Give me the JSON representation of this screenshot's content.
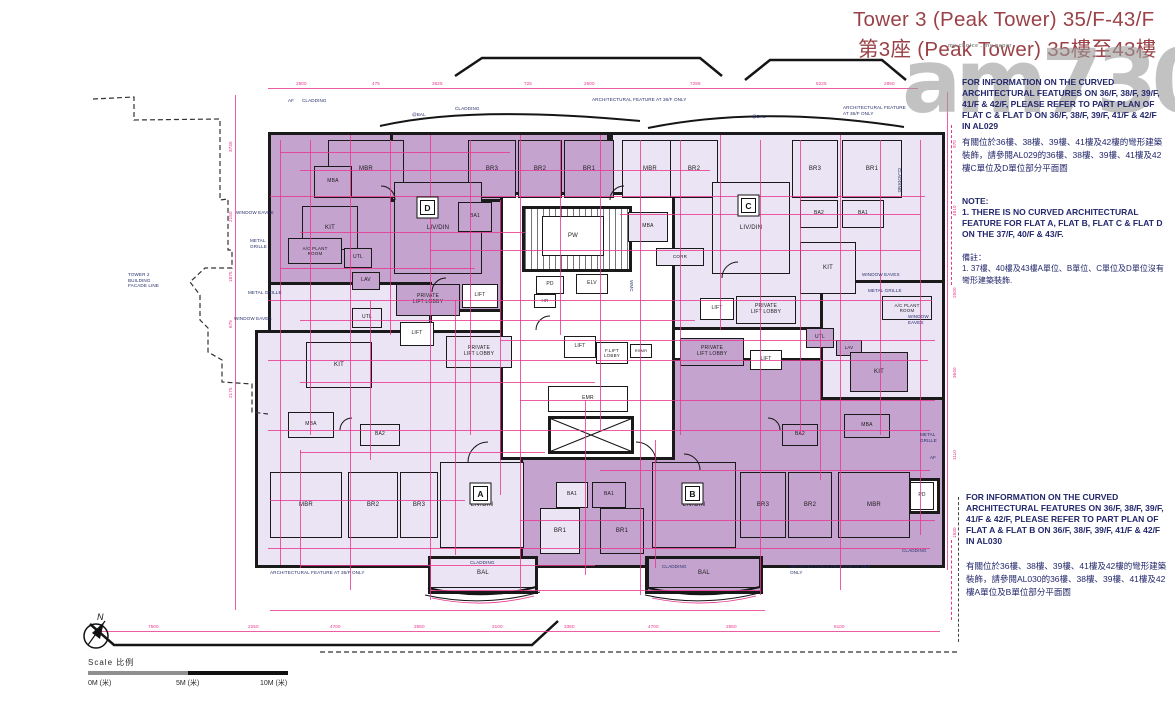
{
  "title": {
    "line1": "Tower 3 (Peak Tower) 35/F-43/F",
    "line2": "第3座 (Peak Tower) 35樓至43樓"
  },
  "watermark": {
    "main": "am730",
    "tagline": "my choice . my paper"
  },
  "notes_right": {
    "al029_en": "FOR INFORMATION ON THE CURVED ARCHITECTURAL FEATURES ON 36/F, 38/F, 39/F, 41/F & 42/F, PLEASE REFER TO PART PLAN OF FLAT C & FLAT D ON 36/F, 38/F, 39/F, 41/F & 42/F IN AL029",
    "al029_zh": "有關位於36樓、38樓、39樓、41樓及42樓的彎形建築裝飾，請參閱AL029的36樓、38樓、39樓、41樓及42樓C單位及D單位部分平面圖",
    "note_title": "NOTE:",
    "note_body": "1. THERE IS NO CURVED ARCHITECTURAL FEATURE FOR FLAT A, FLAT B, FLAT C & FLAT D ON THE 37/F, 40/F & 43/F.",
    "remark_title": "備註：",
    "remark_body": "1. 37樓、40樓及43樓A單位、B單位、C單位及D單位沒有彎形建築裝飾.",
    "al030_en": "FOR INFORMATION ON THE CURVED ARCHITECTURAL FEATURES ON 36/F, 38/F, 39/F, 41/F & 42/F, PLEASE REFER TO PART PLAN OF FLAT A & FLAT B ON 36/F, 38/F, 39/F, 41/F & 42/F IN AL030",
    "al030_zh": "有關位於36樓、38樓、39樓、41樓及42樓的彎形建築裝飾，請參閱AL030的36樓、38樓、39樓、41樓及42樓A單位及B單位部分平面圖"
  },
  "scale": {
    "label": "Scale  比例",
    "t0": "0M (米)",
    "t5": "5M (米)",
    "t10": "10M (米)"
  },
  "compass": {
    "label": "N"
  },
  "colors": {
    "dim_pink": "#e8348c",
    "room_dark": "#c5a3cf",
    "room_light": "#eae4f4",
    "title_maroon": "#9a4247",
    "note_navy": "#23276b"
  },
  "plan": {
    "walls": [
      {
        "x": 268,
        "y": 132,
        "w": 252,
        "h": 180,
        "f": "d"
      },
      {
        "x": 390,
        "y": 132,
        "w": 220,
        "h": 70,
        "f": "d"
      },
      {
        "x": 610,
        "y": 132,
        "w": 335,
        "h": 198,
        "f": "l"
      },
      {
        "x": 268,
        "y": 282,
        "w": 164,
        "h": 178,
        "f": "l"
      },
      {
        "x": 255,
        "y": 330,
        "w": 400,
        "h": 238,
        "f": "l"
      },
      {
        "x": 520,
        "y": 358,
        "w": 425,
        "h": 210,
        "f": "d"
      },
      {
        "x": 820,
        "y": 280,
        "w": 125,
        "h": 120,
        "f": "l"
      },
      {
        "x": 500,
        "y": 192,
        "w": 175,
        "h": 268,
        "f": "w"
      },
      {
        "x": 522,
        "y": 206,
        "w": 110,
        "h": 66,
        "f": "s"
      },
      {
        "x": 548,
        "y": 416,
        "w": 86,
        "h": 38,
        "f": "w"
      },
      {
        "x": 428,
        "y": 556,
        "w": 110,
        "h": 38,
        "f": "l"
      },
      {
        "x": 645,
        "y": 556,
        "w": 118,
        "h": 38,
        "f": "d"
      },
      {
        "x": 908,
        "y": 478,
        "w": 32,
        "h": 36,
        "f": "w"
      }
    ],
    "rooms": [
      {
        "t": "MBR",
        "x": 328,
        "y": 140,
        "w": 76,
        "h": 58,
        "f": "d"
      },
      {
        "t": "MBA",
        "x": 314,
        "y": 166,
        "w": 38,
        "h": 32,
        "f": "d",
        "fs": 5
      },
      {
        "t": "KIT",
        "x": 302,
        "y": 206,
        "w": 56,
        "h": 44,
        "f": "d"
      },
      {
        "t": "BR3",
        "x": 468,
        "y": 140,
        "w": 48,
        "h": 58,
        "f": "d"
      },
      {
        "t": "BR2",
        "x": 518,
        "y": 140,
        "w": 44,
        "h": 58,
        "f": "d"
      },
      {
        "t": "BR1",
        "x": 564,
        "y": 140,
        "w": 50,
        "h": 58,
        "f": "d"
      },
      {
        "t": "LIV/DIN",
        "x": 394,
        "y": 182,
        "w": 88,
        "h": 92,
        "f": "d"
      },
      {
        "t": "BA1",
        "x": 458,
        "y": 202,
        "w": 34,
        "h": 30,
        "f": "d",
        "fs": 5
      },
      {
        "t": "A/C PLANT\nROOM",
        "x": 288,
        "y": 238,
        "w": 54,
        "h": 26,
        "f": "d",
        "fs": 4.5
      },
      {
        "t": "UTL",
        "x": 344,
        "y": 248,
        "w": 28,
        "h": 20,
        "f": "d",
        "fs": 5
      },
      {
        "t": "LAV",
        "x": 352,
        "y": 272,
        "w": 28,
        "h": 18,
        "f": "d",
        "fs": 5
      },
      {
        "t": "PRIVATE\nLIFT LOBBY",
        "x": 396,
        "y": 284,
        "w": 64,
        "h": 32,
        "f": "d",
        "fs": 5
      },
      {
        "t": "MBR",
        "x": 622,
        "y": 140,
        "w": 56,
        "h": 58,
        "f": "l"
      },
      {
        "t": "BR2",
        "x": 670,
        "y": 140,
        "w": 48,
        "h": 58,
        "f": "l"
      },
      {
        "t": "MBA",
        "x": 628,
        "y": 212,
        "w": 40,
        "h": 30,
        "f": "l",
        "fs": 5
      },
      {
        "t": "CORR",
        "x": 656,
        "y": 248,
        "w": 48,
        "h": 18,
        "f": "l",
        "fs": 4.5
      },
      {
        "t": "LIV/DIN",
        "x": 712,
        "y": 182,
        "w": 78,
        "h": 92,
        "f": "l"
      },
      {
        "t": "BR3",
        "x": 792,
        "y": 140,
        "w": 46,
        "h": 58,
        "f": "l"
      },
      {
        "t": "BR1",
        "x": 842,
        "y": 140,
        "w": 60,
        "h": 58,
        "f": "l"
      },
      {
        "t": "BA2",
        "x": 800,
        "y": 200,
        "w": 38,
        "h": 28,
        "f": "l",
        "fs": 5
      },
      {
        "t": "BA1",
        "x": 842,
        "y": 200,
        "w": 42,
        "h": 28,
        "f": "l",
        "fs": 5
      },
      {
        "t": "KIT",
        "x": 800,
        "y": 242,
        "w": 56,
        "h": 52,
        "f": "l"
      },
      {
        "t": "UTL",
        "x": 806,
        "y": 328,
        "w": 28,
        "h": 20,
        "f": "d",
        "fs": 5
      },
      {
        "t": "LAV",
        "x": 836,
        "y": 340,
        "w": 26,
        "h": 16,
        "f": "d",
        "fs": 4.5
      },
      {
        "t": "A/C PLANT\nROOM",
        "x": 882,
        "y": 296,
        "w": 50,
        "h": 24,
        "f": "l",
        "fs": 4.5
      },
      {
        "t": "KIT",
        "x": 850,
        "y": 352,
        "w": 58,
        "h": 40,
        "f": "d"
      },
      {
        "t": "MBA",
        "x": 288,
        "y": 412,
        "w": 46,
        "h": 26,
        "f": "l",
        "fs": 5
      },
      {
        "t": "BA2",
        "x": 360,
        "y": 424,
        "w": 40,
        "h": 22,
        "f": "l",
        "fs": 5
      },
      {
        "t": "MBR",
        "x": 270,
        "y": 472,
        "w": 72,
        "h": 66,
        "f": "l"
      },
      {
        "t": "BR2",
        "x": 348,
        "y": 472,
        "w": 50,
        "h": 66,
        "f": "l"
      },
      {
        "t": "BR3",
        "x": 400,
        "y": 472,
        "w": 38,
        "h": 66,
        "f": "l"
      },
      {
        "t": "LIV/DIN",
        "x": 440,
        "y": 462,
        "w": 84,
        "h": 86,
        "f": "l"
      },
      {
        "t": "BA1",
        "x": 556,
        "y": 482,
        "w": 32,
        "h": 26,
        "f": "l",
        "fs": 5
      },
      {
        "t": "BR1",
        "x": 540,
        "y": 508,
        "w": 40,
        "h": 46,
        "f": "l"
      },
      {
        "t": "KIT",
        "x": 306,
        "y": 342,
        "w": 66,
        "h": 46,
        "f": "l"
      },
      {
        "t": "UTL",
        "x": 352,
        "y": 308,
        "w": 30,
        "h": 20,
        "f": "l",
        "fs": 5
      },
      {
        "t": "BAL",
        "x": 430,
        "y": 558,
        "w": 106,
        "h": 30,
        "f": "l"
      },
      {
        "t": "BA1",
        "x": 592,
        "y": 482,
        "w": 34,
        "h": 26,
        "f": "d",
        "fs": 5
      },
      {
        "t": "BR1",
        "x": 600,
        "y": 508,
        "w": 44,
        "h": 46,
        "f": "d"
      },
      {
        "t": "LIV/DIN",
        "x": 652,
        "y": 462,
        "w": 84,
        "h": 86,
        "f": "d"
      },
      {
        "t": "BR3",
        "x": 740,
        "y": 472,
        "w": 46,
        "h": 66,
        "f": "d"
      },
      {
        "t": "BR2",
        "x": 788,
        "y": 472,
        "w": 44,
        "h": 66,
        "f": "d"
      },
      {
        "t": "MBR",
        "x": 838,
        "y": 472,
        "w": 72,
        "h": 66,
        "f": "d"
      },
      {
        "t": "MBA",
        "x": 844,
        "y": 414,
        "w": 46,
        "h": 24,
        "f": "d",
        "fs": 5
      },
      {
        "t": "BA2",
        "x": 782,
        "y": 424,
        "w": 36,
        "h": 22,
        "f": "d",
        "fs": 5
      },
      {
        "t": "BAL",
        "x": 648,
        "y": 558,
        "w": 112,
        "h": 30,
        "f": "d"
      },
      {
        "t": "PD",
        "x": 910,
        "y": 482,
        "w": 24,
        "h": 28,
        "f": "w",
        "fs": 5
      },
      {
        "t": "PW",
        "x": 542,
        "y": 216,
        "w": 62,
        "h": 40,
        "f": "w"
      },
      {
        "t": "PD",
        "x": 536,
        "y": 276,
        "w": 28,
        "h": 18,
        "f": "w",
        "fs": 5
      },
      {
        "t": "HR",
        "x": 534,
        "y": 294,
        "w": 22,
        "h": 14,
        "f": "w",
        "fs": 4.5
      },
      {
        "t": "ELV",
        "x": 576,
        "y": 274,
        "w": 32,
        "h": 20,
        "f": "w",
        "fs": 5
      },
      {
        "t": "EMR",
        "x": 548,
        "y": 386,
        "w": 80,
        "h": 26,
        "f": "w",
        "fs": 5
      },
      {
        "t": "LIFT",
        "x": 462,
        "y": 284,
        "w": 36,
        "h": 24,
        "f": "w",
        "fs": 5
      },
      {
        "t": "LIFT",
        "x": 400,
        "y": 322,
        "w": 34,
        "h": 24,
        "f": "w",
        "fs": 5
      },
      {
        "t": "PRIVATE\nLIFT LOBBY",
        "x": 446,
        "y": 336,
        "w": 66,
        "h": 32,
        "f": "l",
        "fs": 5
      },
      {
        "t": "LIFT",
        "x": 564,
        "y": 336,
        "w": 32,
        "h": 22,
        "f": "w",
        "fs": 5
      },
      {
        "t": "F.LIFT\nLOBBY",
        "x": 596,
        "y": 342,
        "w": 32,
        "h": 22,
        "f": "w",
        "fs": 4.5
      },
      {
        "t": "RSMR",
        "x": 630,
        "y": 344,
        "w": 22,
        "h": 14,
        "f": "w",
        "fs": 4
      },
      {
        "t": "LIFT",
        "x": 700,
        "y": 298,
        "w": 34,
        "h": 22,
        "f": "w",
        "fs": 5
      },
      {
        "t": "PRIVATE\nLIFT LOBBY",
        "x": 736,
        "y": 296,
        "w": 60,
        "h": 28,
        "f": "l",
        "fs": 5
      },
      {
        "t": "PRIVATE\nLIFT LOBBY",
        "x": 680,
        "y": 338,
        "w": 64,
        "h": 28,
        "f": "d",
        "fs": 5
      },
      {
        "t": "LIFT",
        "x": 750,
        "y": 350,
        "w": 32,
        "h": 20,
        "f": "w",
        "fs": 5
      }
    ],
    "badges": [
      {
        "t": "D",
        "x": 420,
        "y": 200
      },
      {
        "t": "C",
        "x": 741,
        "y": 198
      },
      {
        "t": "A",
        "x": 473,
        "y": 486
      },
      {
        "t": "B",
        "x": 685,
        "y": 486
      }
    ],
    "labels": [
      {
        "t": "ARCHITECTURAL FEATURE AT 36/F ONLY",
        "x": 592,
        "y": 97,
        "w": 100
      },
      {
        "t": "ARCHITECTURAL FEATURE\nAT 36/F ONLY",
        "x": 843,
        "y": 105,
        "w": 72
      },
      {
        "t": "AF",
        "x": 288,
        "y": 98,
        "w": 12
      },
      {
        "t": "CLADDING",
        "x": 302,
        "y": 98,
        "w": 42
      },
      {
        "t": "@BAL",
        "x": 412,
        "y": 112,
        "w": 30
      },
      {
        "t": "CLADDING",
        "x": 455,
        "y": 106,
        "w": 42
      },
      {
        "t": "@BAL",
        "x": 752,
        "y": 114,
        "w": 30
      },
      {
        "t": "WINDOW EAVES",
        "x": 236,
        "y": 210,
        "w": 54
      },
      {
        "t": "METAL\nGRILLE",
        "x": 250,
        "y": 238,
        "w": 30
      },
      {
        "t": "TOWER 2\nBUILDING\nFACADE LINE",
        "x": 128,
        "y": 272,
        "w": 52
      },
      {
        "t": "METAL GRILLE",
        "x": 248,
        "y": 290,
        "w": 52
      },
      {
        "t": "WINDOW EAVES",
        "x": 234,
        "y": 316,
        "w": 54
      },
      {
        "t": "WINDOW EAVES",
        "x": 862,
        "y": 272,
        "w": 56
      },
      {
        "t": "METAL GRILLE",
        "x": 868,
        "y": 288,
        "w": 54
      },
      {
        "t": "WINDOW\nEAVES",
        "x": 908,
        "y": 314,
        "w": 36
      },
      {
        "t": "METAL\nGRILLE",
        "x": 920,
        "y": 432,
        "w": 30
      },
      {
        "t": "CLADDING",
        "x": 902,
        "y": 168,
        "w": 40,
        "r": 1
      },
      {
        "t": "ARCHITECTURAL FEATURE AT 36/F ONLY",
        "x": 270,
        "y": 570,
        "w": 140
      },
      {
        "t": "ARCHITECTURAL FEATURE AT 36/F ONLY",
        "x": 790,
        "y": 564,
        "w": 84
      },
      {
        "t": "CLADDING",
        "x": 470,
        "y": 560,
        "w": 40
      },
      {
        "t": "CLADDING",
        "x": 662,
        "y": 564,
        "w": 40
      },
      {
        "t": "CLADDING",
        "x": 902,
        "y": 548,
        "w": 40
      },
      {
        "t": "WMC",
        "x": 634,
        "y": 280,
        "r": 1
      },
      {
        "t": "AF",
        "x": 930,
        "y": 455,
        "w": 12
      }
    ],
    "dims": {
      "h": [
        [
          268,
          88,
          650
        ],
        [
          95,
          631,
          845
        ],
        [
          280,
          152,
          230
        ],
        [
          300,
          170,
          410
        ],
        [
          270,
          196,
          655
        ],
        [
          620,
          214,
          300
        ],
        [
          300,
          232,
          225
        ],
        [
          430,
          250,
          490
        ],
        [
          280,
          268,
          195
        ],
        [
          268,
          300,
          664
        ],
        [
          300,
          320,
          395
        ],
        [
          500,
          340,
          435
        ],
        [
          268,
          360,
          660
        ],
        [
          300,
          382,
          295
        ],
        [
          520,
          400,
          415
        ],
        [
          268,
          430,
          662
        ],
        [
          300,
          452,
          245
        ],
        [
          600,
          470,
          330
        ],
        [
          270,
          500,
          195
        ],
        [
          520,
          520,
          415
        ],
        [
          268,
          548,
          662
        ],
        [
          300,
          565,
          295
        ],
        [
          430,
          590,
          330
        ],
        [
          270,
          610,
          495
        ]
      ],
      "v": [
        [
          235,
          95,
          515
        ],
        [
          947,
          92,
          478
        ],
        [
          280,
          140,
          425
        ],
        [
          310,
          140,
          295
        ],
        [
          350,
          135,
          455
        ],
        [
          390,
          140,
          195
        ],
        [
          430,
          135,
          465
        ],
        [
          470,
          140,
          295
        ],
        [
          500,
          200,
          295
        ],
        [
          520,
          135,
          455
        ],
        [
          560,
          140,
          195
        ],
        [
          600,
          135,
          295
        ],
        [
          640,
          140,
          455
        ],
        [
          680,
          140,
          295
        ],
        [
          720,
          135,
          195
        ],
        [
          760,
          140,
          455
        ],
        [
          800,
          140,
          295
        ],
        [
          840,
          135,
          455
        ],
        [
          880,
          140,
          295
        ],
        [
          920,
          140,
          395
        ],
        [
          455,
          300,
          255
        ],
        [
          585,
          400,
          175
        ],
        [
          655,
          440,
          128
        ],
        [
          300,
          450,
          118
        ],
        [
          370,
          300,
          160
        ],
        [
          820,
          330,
          150
        ]
      ]
    },
    "dim_labels": [
      {
        "t": "2800",
        "x": 296,
        "y": 81
      },
      {
        "t": "475",
        "x": 372,
        "y": 81
      },
      {
        "t": "3625",
        "x": 432,
        "y": 81
      },
      {
        "t": "725",
        "x": 524,
        "y": 81
      },
      {
        "t": "2600",
        "x": 584,
        "y": 81
      },
      {
        "t": "7286",
        "x": 690,
        "y": 81
      },
      {
        "t": "5225",
        "x": 816,
        "y": 81
      },
      {
        "t": "2850",
        "x": 884,
        "y": 81
      },
      {
        "t": "7500",
        "x": 148,
        "y": 624
      },
      {
        "t": "2250",
        "x": 248,
        "y": 624
      },
      {
        "t": "4700",
        "x": 330,
        "y": 624
      },
      {
        "t": "2850",
        "x": 414,
        "y": 624
      },
      {
        "t": "3100",
        "x": 492,
        "y": 624
      },
      {
        "t": "3350",
        "x": 564,
        "y": 624
      },
      {
        "t": "4700",
        "x": 648,
        "y": 624
      },
      {
        "t": "2850",
        "x": 726,
        "y": 624
      },
      {
        "t": "8100",
        "x": 834,
        "y": 624
      },
      {
        "t": "3745",
        "x": 228,
        "y": 152,
        "r": 1
      },
      {
        "t": "2150",
        "x": 228,
        "y": 222,
        "r": 1
      },
      {
        "t": "1875",
        "x": 228,
        "y": 282,
        "r": 1
      },
      {
        "t": "675",
        "x": 228,
        "y": 328,
        "r": 1
      },
      {
        "t": "2175",
        "x": 228,
        "y": 398,
        "r": 1
      },
      {
        "t": "970",
        "x": 952,
        "y": 148,
        "r": 1
      },
      {
        "t": "4810",
        "x": 952,
        "y": 216,
        "r": 1
      },
      {
        "t": "2500",
        "x": 952,
        "y": 298,
        "r": 1
      },
      {
        "t": "3640",
        "x": 952,
        "y": 378,
        "r": 1
      },
      {
        "t": "1110",
        "x": 952,
        "y": 460,
        "r": 1
      },
      {
        "t": "1930",
        "x": 952,
        "y": 538,
        "r": 1
      }
    ]
  }
}
